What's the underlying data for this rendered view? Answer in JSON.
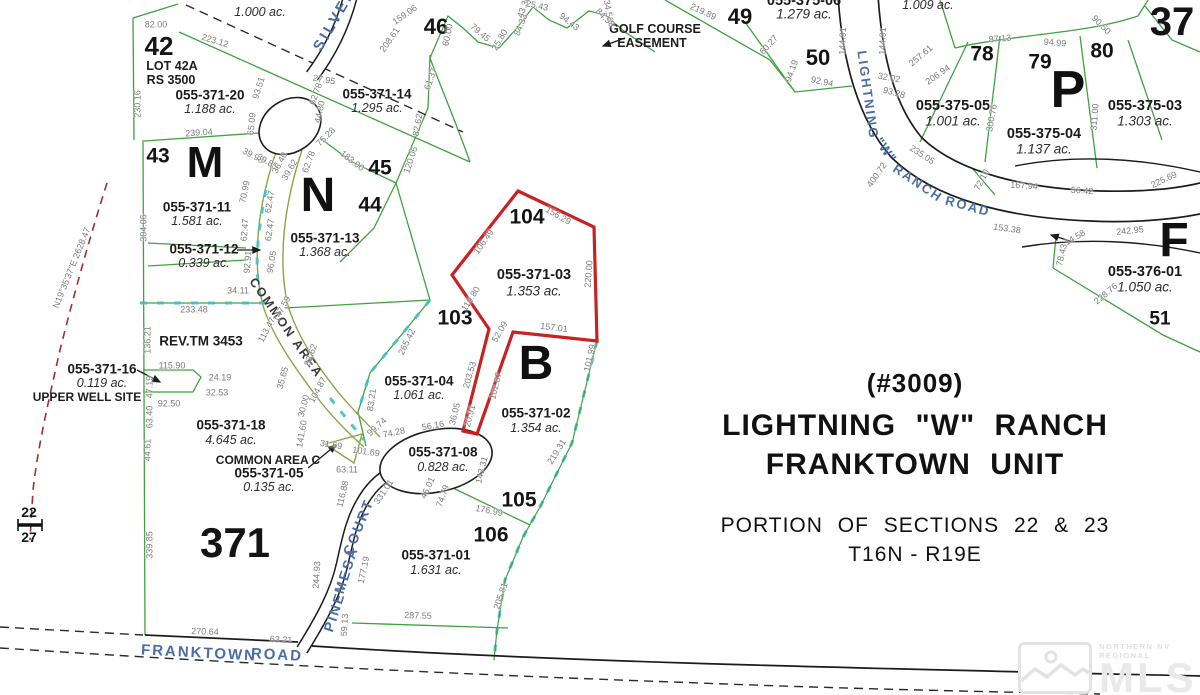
{
  "title_block": {
    "permit": "(#3009)",
    "name_line1": "LIGHTNING \"W\" RANCH",
    "name_line2": "FRANKTOWN UNIT",
    "sections_line": "PORTION OF SECTIONS 22 & 23",
    "township_line": "T16N - R19E"
  },
  "watermark": {
    "small_text": "NORTHERN NV REGIONAL",
    "big_text": "MLS"
  },
  "colors": {
    "parcel_line_green": "#3fa23f",
    "common_area_olive": "#8aa545",
    "boundary_teal": "#45c0c0",
    "highlight_red": "#c92121",
    "road_black": "#1c1c1c",
    "road_name_blue": "#4a6da8",
    "dimension_gray": "#7b7b7b",
    "survey_dash_red": "#9c2f2f"
  },
  "map": {
    "lot_numbers": [
      {
        "t": "42",
        "x": 159,
        "y": 46,
        "s": 26
      },
      {
        "t": "43",
        "x": 158,
        "y": 156,
        "s": 21
      },
      {
        "t": "44",
        "x": 370,
        "y": 205,
        "s": 21
      },
      {
        "t": "45",
        "x": 380,
        "y": 168,
        "s": 21
      },
      {
        "t": "46",
        "x": 436,
        "y": 27,
        "s": 22
      },
      {
        "t": "49",
        "x": 740,
        "y": 17,
        "s": 22
      },
      {
        "t": "50",
        "x": 818,
        "y": 58,
        "s": 22
      },
      {
        "t": "51",
        "x": 1160,
        "y": 319,
        "s": 19
      },
      {
        "t": "78",
        "x": 982,
        "y": 54,
        "s": 21
      },
      {
        "t": "79",
        "x": 1040,
        "y": 62,
        "s": 21
      },
      {
        "t": "80",
        "x": 1102,
        "y": 51,
        "s": 21
      },
      {
        "t": "103",
        "x": 455,
        "y": 318,
        "s": 21
      },
      {
        "t": "104",
        "x": 527,
        "y": 217,
        "s": 21
      },
      {
        "t": "105",
        "x": 519,
        "y": 500,
        "s": 21
      },
      {
        "t": "106",
        "x": 491,
        "y": 535,
        "s": 21
      },
      {
        "t": "371",
        "x": 235,
        "y": 543,
        "s": 42
      },
      {
        "t": "37",
        "x": 1172,
        "y": 22,
        "s": 40
      },
      {
        "t": "22",
        "x": 29,
        "y": 512,
        "s": 14
      },
      {
        "t": "27",
        "x": 29,
        "y": 537,
        "s": 14
      }
    ],
    "block_letters": [
      {
        "t": "M",
        "x": 205,
        "y": 163,
        "s": 44
      },
      {
        "t": "N",
        "x": 318,
        "y": 196,
        "s": 48
      },
      {
        "t": "B",
        "x": 536,
        "y": 364,
        "s": 48
      },
      {
        "t": "P",
        "x": 1068,
        "y": 90,
        "s": 52
      },
      {
        "t": "F",
        "x": 1174,
        "y": 241,
        "s": 48
      }
    ],
    "parcels": [
      {
        "apn": "055-371-20",
        "acreage": "1.188 ac.",
        "x": 210,
        "y": 95
      },
      {
        "apn": "055-371-14",
        "acreage": "1.295 ac.",
        "x": 377,
        "y": 94
      },
      {
        "apn": "055-371-11",
        "acreage": "1.581 ac.",
        "x": 197,
        "y": 207
      },
      {
        "apn": "055-371-12",
        "acreage": "0.339 ac.",
        "x": 204,
        "y": 249
      },
      {
        "apn": "055-371-13",
        "acreage": "1.368 ac.",
        "x": 325,
        "y": 238
      },
      {
        "apn": "055-371-03",
        "acreage": "1.353 ac.",
        "x": 534,
        "y": 275,
        "s": 14.5,
        "dy": 16
      },
      {
        "apn": "055-371-04",
        "acreage": "1.061 ac.",
        "x": 419,
        "y": 381
      },
      {
        "apn": "055-371-02",
        "acreage": "1.354 ac.",
        "x": 536,
        "y": 413,
        "dy": 15
      },
      {
        "apn": "055-371-08",
        "acreage": "0.828 ac.",
        "x": 443,
        "y": 452,
        "dy": 15
      },
      {
        "apn": "055-371-01",
        "acreage": "1.631 ac.",
        "x": 436,
        "y": 555,
        "dy": 15
      },
      {
        "apn": "055-371-16",
        "acreage": "0.119 ac.",
        "x": 102,
        "y": 369
      },
      {
        "apn": "055-371-18",
        "acreage": "4.645 ac.",
        "x": 231,
        "y": 425,
        "dy": 15
      },
      {
        "apn": "055-371-05",
        "acreage": "0.135 ac.",
        "x": 269,
        "y": 473
      },
      {
        "apn": "055-375-05",
        "acreage": "1.001 ac.",
        "x": 953,
        "y": 106,
        "s": 14.5,
        "dy": 15
      },
      {
        "apn": "055-375-04",
        "acreage": "1.137 ac.",
        "x": 1044,
        "y": 134,
        "s": 14.5,
        "dy": 15
      },
      {
        "apn": "055-375-03",
        "acreage": "1.303 ac.",
        "x": 1145,
        "y": 106,
        "s": 14.5,
        "dy": 15
      },
      {
        "apn": "055-376-01",
        "acreage": "1.050 ac.",
        "x": 1145,
        "y": 272,
        "s": 14.5,
        "dy": 15
      },
      {
        "apn": "055-375-06",
        "acreage": "1.279 ac.",
        "x": 804,
        "y": 1,
        "s": 14.5,
        "dy": 13
      },
      {
        "apn": "",
        "acreage": "1.009 ac.",
        "x": 928,
        "y": -8,
        "dy": 13
      },
      {
        "apn": "",
        "acreage": "1.000 ac.",
        "x": 260,
        "y": -2,
        "dy": 14
      }
    ],
    "notes": [
      {
        "t": "LOT 42A",
        "x": 172,
        "y": 66
      },
      {
        "t": "RS 3500",
        "x": 171,
        "y": 80
      },
      {
        "t": "REV.TM 3453",
        "x": 201,
        "y": 341,
        "s": 13.5
      },
      {
        "t": "UPPER WELL SITE",
        "x": 87,
        "y": 397,
        "s": 12
      },
      {
        "t": "COMMON AREA C",
        "x": 268,
        "y": 460,
        "s": 12
      },
      {
        "t": "GOLF COURSE",
        "x": 655,
        "y": 29,
        "s": 12.5
      },
      {
        "t": "EASEMENT",
        "x": 652,
        "y": 43,
        "s": 12.5
      }
    ],
    "roads": [
      {
        "t": "SILVER",
        "x": 335,
        "y": 19,
        "r": -60,
        "s": 15,
        "ls": 3
      },
      {
        "t": "LIGHTNING",
        "x": 868,
        "y": 95,
        "r": 82,
        "s": 13,
        "ls": 2
      },
      {
        "t": "\"W\"",
        "x": 886,
        "y": 150,
        "r": 55,
        "s": 13,
        "ls": 1
      },
      {
        "t": "RANCH",
        "x": 918,
        "y": 183,
        "r": 34,
        "s": 13,
        "ls": 2
      },
      {
        "t": "ROAD",
        "x": 968,
        "y": 206,
        "r": 15,
        "s": 13,
        "ls": 2
      },
      {
        "t": "PINE",
        "x": 334,
        "y": 612,
        "r": -72,
        "s": 14,
        "ls": 2
      },
      {
        "t": "MESA",
        "x": 346,
        "y": 570,
        "r": -72,
        "s": 14,
        "ls": 2
      },
      {
        "t": "COURT",
        "x": 358,
        "y": 527,
        "r": -68,
        "s": 14,
        "ls": 2
      },
      {
        "t": "FRANKTOWN",
        "x": 199,
        "y": 653,
        "r": 3,
        "s": 15,
        "ls": 2
      },
      {
        "t": "ROAD",
        "x": 277,
        "y": 655,
        "r": 3,
        "s": 15,
        "ls": 2
      },
      {
        "t": "COMMON AREA",
        "x": 286,
        "y": 328,
        "r": 55,
        "s": 12.5,
        "ls": 2,
        "c": "#383838"
      }
    ],
    "dimensions": [
      {
        "t": "82.00",
        "x": 156,
        "y": 25,
        "r": 0
      },
      {
        "t": "223.12",
        "x": 215,
        "y": 41,
        "r": 17
      },
      {
        "t": "230.16",
        "x": 138,
        "y": 104,
        "r": -90
      },
      {
        "t": "239.04",
        "x": 199,
        "y": 133,
        "r": -4
      },
      {
        "t": "304.06",
        "x": 144,
        "y": 228,
        "r": -90
      },
      {
        "t": "136.21",
        "x": 148,
        "y": 340,
        "r": -90
      },
      {
        "t": "93.51",
        "x": 259,
        "y": 88,
        "r": -72
      },
      {
        "t": "65.09",
        "x": 252,
        "y": 124,
        "r": -84
      },
      {
        "t": "27.95",
        "x": 324,
        "y": 80,
        "r": 10
      },
      {
        "t": "44.80",
        "x": 320,
        "y": 112,
        "r": -78
      },
      {
        "t": "62.78",
        "x": 316,
        "y": 94,
        "r": -70
      },
      {
        "t": "39.98",
        "x": 253,
        "y": 156,
        "r": 28
      },
      {
        "t": "39.85",
        "x": 267,
        "y": 162,
        "r": 30
      },
      {
        "t": "36.40",
        "x": 280,
        "y": 163,
        "r": -62
      },
      {
        "t": "39.62",
        "x": 290,
        "y": 170,
        "r": -60
      },
      {
        "t": "62.78",
        "x": 309,
        "y": 162,
        "r": -70
      },
      {
        "t": "75.28",
        "x": 326,
        "y": 137,
        "r": -45
      },
      {
        "t": "183.00",
        "x": 352,
        "y": 161,
        "r": 38
      },
      {
        "t": "120.06",
        "x": 411,
        "y": 160,
        "r": -72
      },
      {
        "t": "82.62",
        "x": 418,
        "y": 125,
        "r": -80
      },
      {
        "t": "61.37",
        "x": 431,
        "y": 79,
        "r": -70
      },
      {
        "t": "159.06",
        "x": 405,
        "y": 15,
        "r": -35
      },
      {
        "t": "208.61",
        "x": 390,
        "y": 40,
        "r": -55
      },
      {
        "t": "60.00",
        "x": 448,
        "y": 35,
        "r": -78
      },
      {
        "t": "79.45",
        "x": 480,
        "y": 33,
        "r": 40
      },
      {
        "t": "25.80",
        "x": 500,
        "y": 40,
        "r": -60
      },
      {
        "t": "84.33",
        "x": 521,
        "y": 25,
        "r": -68
      },
      {
        "t": "43.30",
        "x": 524,
        "y": 7,
        "r": -70
      },
      {
        "t": "25.43",
        "x": 537,
        "y": 6,
        "r": 12
      },
      {
        "t": "94.43",
        "x": 569,
        "y": 22,
        "r": 38
      },
      {
        "t": "34.56",
        "x": 608,
        "y": 11,
        "r": 80
      },
      {
        "t": "84.58",
        "x": 605,
        "y": 18,
        "r": 45
      },
      {
        "t": "70.99",
        "x": 245,
        "y": 192,
        "r": -78
      },
      {
        "t": "62.47",
        "x": 270,
        "y": 202,
        "r": -80
      },
      {
        "t": "62.47",
        "x": 245,
        "y": 230,
        "r": -85
      },
      {
        "t": "62.47",
        "x": 270,
        "y": 230,
        "r": -82
      },
      {
        "t": "92.91",
        "x": 248,
        "y": 262,
        "r": -85
      },
      {
        "t": "96.05",
        "x": 272,
        "y": 262,
        "r": -80
      },
      {
        "t": "34.11",
        "x": 238,
        "y": 291,
        "r": 0
      },
      {
        "t": "233.48",
        "x": 194,
        "y": 310,
        "r": 0
      },
      {
        "t": "113.47",
        "x": 267,
        "y": 330,
        "r": -62
      },
      {
        "t": "147.59",
        "x": 282,
        "y": 309,
        "r": -62
      },
      {
        "t": "83.62",
        "x": 311,
        "y": 355,
        "r": -70
      },
      {
        "t": "35.65",
        "x": 283,
        "y": 378,
        "r": -75
      },
      {
        "t": "30.00",
        "x": 304,
        "y": 406,
        "r": -75
      },
      {
        "t": "104.87",
        "x": 318,
        "y": 390,
        "r": -62
      },
      {
        "t": "141.60",
        "x": 302,
        "y": 434,
        "r": -80
      },
      {
        "t": "115.90",
        "x": 172,
        "y": 366,
        "r": 0
      },
      {
        "t": "24.19",
        "x": 220,
        "y": 378,
        "r": 0
      },
      {
        "t": "32.53",
        "x": 217,
        "y": 393,
        "r": 0
      },
      {
        "t": "92.50",
        "x": 169,
        "y": 404,
        "r": 0
      },
      {
        "t": "47.19",
        "x": 150,
        "y": 387,
        "r": -90
      },
      {
        "t": "63.40",
        "x": 150,
        "y": 417,
        "r": -90
      },
      {
        "t": "44.61",
        "x": 148,
        "y": 450,
        "r": -90
      },
      {
        "t": "339.85",
        "x": 150,
        "y": 545,
        "r": -90
      },
      {
        "t": "270.64",
        "x": 205,
        "y": 632,
        "r": 2
      },
      {
        "t": "63.21",
        "x": 281,
        "y": 640,
        "r": 3
      },
      {
        "t": "287.55",
        "x": 418,
        "y": 616,
        "r": 2
      },
      {
        "t": "205.81",
        "x": 501,
        "y": 596,
        "r": -72
      },
      {
        "t": "219.31",
        "x": 557,
        "y": 452,
        "r": -58
      },
      {
        "t": "177.19",
        "x": 364,
        "y": 570,
        "r": -78
      },
      {
        "t": "244.93",
        "x": 317,
        "y": 575,
        "r": -87
      },
      {
        "t": "59.13",
        "x": 345,
        "y": 625,
        "r": -87
      },
      {
        "t": "176.99",
        "x": 489,
        "y": 511,
        "r": 11
      },
      {
        "t": "143.31",
        "x": 482,
        "y": 470,
        "r": -76
      },
      {
        "t": "46.01",
        "x": 428,
        "y": 488,
        "r": -65
      },
      {
        "t": "74.79",
        "x": 443,
        "y": 496,
        "r": -70
      },
      {
        "t": "331.01",
        "x": 384,
        "y": 492,
        "r": -56
      },
      {
        "t": "116.88",
        "x": 343,
        "y": 494,
        "r": -77
      },
      {
        "t": "63.11",
        "x": 347,
        "y": 470,
        "r": 0
      },
      {
        "t": "31.69",
        "x": 331,
        "y": 445,
        "r": 9
      },
      {
        "t": "74.28",
        "x": 394,
        "y": 433,
        "r": -12
      },
      {
        "t": "56.16",
        "x": 433,
        "y": 426,
        "r": -10
      },
      {
        "t": "36.05",
        "x": 455,
        "y": 414,
        "r": -76
      },
      {
        "t": "20.91",
        "x": 470,
        "y": 416,
        "r": -76
      },
      {
        "t": "102.87",
        "x": 496,
        "y": 386,
        "r": -76
      },
      {
        "t": "203.53",
        "x": 470,
        "y": 375,
        "r": -74
      },
      {
        "t": "265.42",
        "x": 407,
        "y": 342,
        "r": -64
      },
      {
        "t": "83.21",
        "x": 372,
        "y": 400,
        "r": -82
      },
      {
        "t": "99.74",
        "x": 377,
        "y": 427,
        "r": -42
      },
      {
        "t": "101.69",
        "x": 366,
        "y": 452,
        "r": 8
      },
      {
        "t": "157.01",
        "x": 554,
        "y": 328,
        "r": 7
      },
      {
        "t": "101.99",
        "x": 590,
        "y": 358,
        "r": -77
      },
      {
        "t": "220.00",
        "x": 589,
        "y": 274,
        "r": -86
      },
      {
        "t": "156.29",
        "x": 558,
        "y": 216,
        "r": 30
      },
      {
        "t": "106.49",
        "x": 484,
        "y": 242,
        "r": -55
      },
      {
        "t": "119.80",
        "x": 471,
        "y": 299,
        "r": -58
      },
      {
        "t": "52.09",
        "x": 500,
        "y": 332,
        "r": -60
      },
      {
        "t": "144.91",
        "x": 843,
        "y": 41,
        "r": -88
      },
      {
        "t": "144.91",
        "x": 883,
        "y": 41,
        "r": -88
      },
      {
        "t": "92.94",
        "x": 822,
        "y": 82,
        "r": 12
      },
      {
        "t": "60.27",
        "x": 769,
        "y": 45,
        "r": -48
      },
      {
        "t": "94.19",
        "x": 792,
        "y": 71,
        "r": -70
      },
      {
        "t": "219.89",
        "x": 703,
        "y": 12,
        "r": 25
      },
      {
        "t": "32.02",
        "x": 889,
        "y": 78,
        "r": 10
      },
      {
        "t": "93.28",
        "x": 894,
        "y": 93,
        "r": 15
      },
      {
        "t": "257.61",
        "x": 921,
        "y": 56,
        "r": -40
      },
      {
        "t": "206.94",
        "x": 938,
        "y": 75,
        "r": -35
      },
      {
        "t": "87.13",
        "x": 1000,
        "y": 39,
        "r": -5
      },
      {
        "t": "94.99",
        "x": 1055,
        "y": 43,
        "r": 5
      },
      {
        "t": "90.50",
        "x": 1101,
        "y": 25,
        "r": 45
      },
      {
        "t": "311.00",
        "x": 1095,
        "y": 117,
        "r": -86
      },
      {
        "t": "300.76",
        "x": 992,
        "y": 118,
        "r": -80
      },
      {
        "t": "72.10",
        "x": 982,
        "y": 180,
        "r": -62
      },
      {
        "t": "167.94",
        "x": 1024,
        "y": 186,
        "r": 4
      },
      {
        "t": "56.42",
        "x": 1082,
        "y": 191,
        "r": 4
      },
      {
        "t": "235.05",
        "x": 922,
        "y": 155,
        "r": 33
      },
      {
        "t": "400.72",
        "x": 877,
        "y": 175,
        "r": -55
      },
      {
        "t": "153.38",
        "x": 1007,
        "y": 229,
        "r": 8
      },
      {
        "t": "225.69",
        "x": 1164,
        "y": 180,
        "r": -25
      },
      {
        "t": "242.95",
        "x": 1130,
        "y": 231,
        "r": -6
      },
      {
        "t": "14.58",
        "x": 1075,
        "y": 238,
        "r": -30
      },
      {
        "t": "78.43",
        "x": 1062,
        "y": 255,
        "r": -77
      },
      {
        "t": "228.76",
        "x": 1106,
        "y": 294,
        "r": -40
      },
      {
        "t": "N19°35'37\"E 2628.47",
        "x": 72,
        "y": 268,
        "r": -68
      }
    ]
  }
}
